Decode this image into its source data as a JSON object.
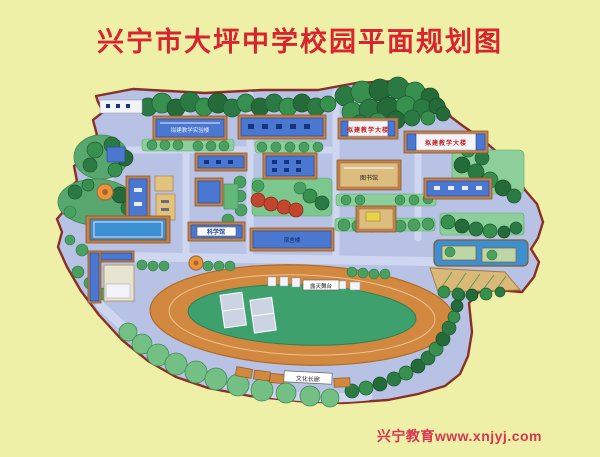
{
  "title": "兴宁市大坪中学校园平面规划图",
  "footer": "兴宁教育www.xnjyj.com",
  "colors": {
    "page_background": "#edf0a6",
    "title_red": "#d9232e",
    "footer_red": "#d93552",
    "map_paper": "#b7c2e4",
    "map_outline": "#8a2f26",
    "tree_green": "#2c7a43",
    "lawn_green": "#8ccf9a",
    "track_orange": "#d2883e",
    "field_green": "#3ea06c",
    "building_blue": "#4a77d0",
    "pond_blue": "#3c8fd0"
  },
  "map": {
    "labels": [
      {
        "id": "lab-building",
        "text": "拟建教学实验楼"
      },
      {
        "id": "planned-teaching-building-1",
        "text": "拟建教学大楼"
      },
      {
        "id": "planned-teaching-building-2",
        "text": "拟建教学大楼"
      },
      {
        "id": "library",
        "text": "图书馆"
      },
      {
        "id": "science-hall",
        "text": "科学馆"
      },
      {
        "id": "dormitory",
        "text": "宿舍楼"
      },
      {
        "id": "open-air-stage",
        "text": "露天舞台"
      },
      {
        "id": "culture-corridor",
        "text": "文化长廊"
      }
    ]
  }
}
